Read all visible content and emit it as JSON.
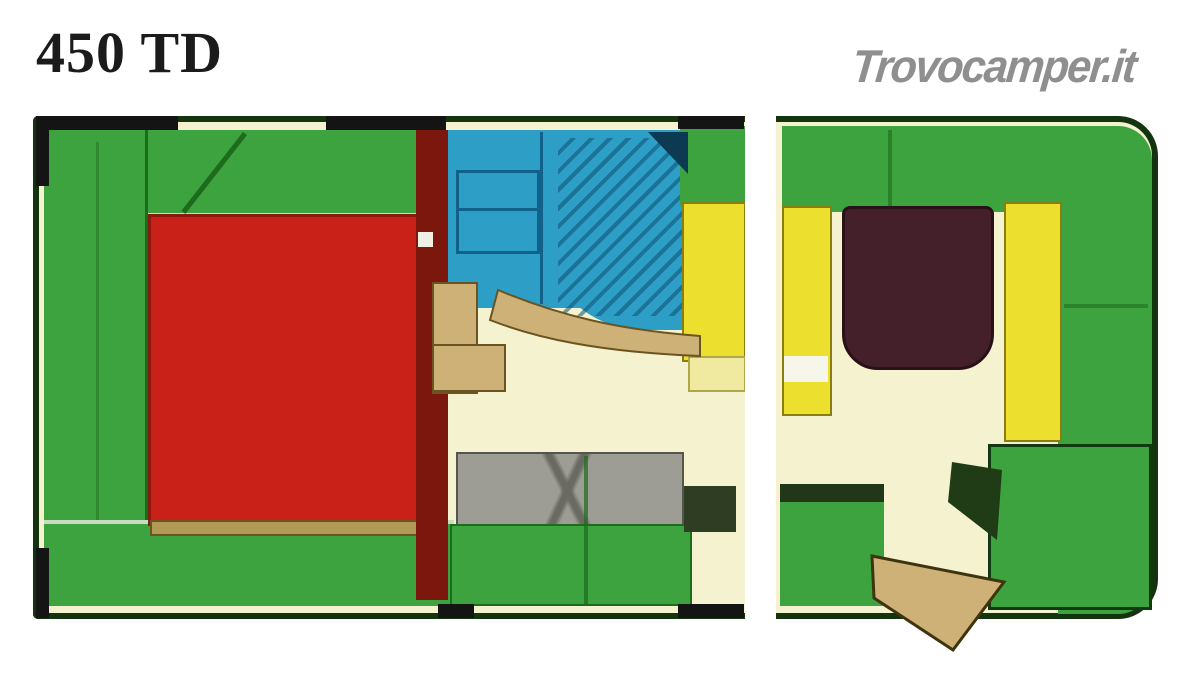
{
  "header": {
    "model_title": "450 TD"
  },
  "watermark": {
    "brand": "Trovocamper.it"
  },
  "palette": {
    "page_white": "#ffffff",
    "outline": "#14330f",
    "wall_green": "#3da33e",
    "green_dark_seam": "#1d6b1d",
    "dark_backrest_green": "#223618",
    "floor_cream": "#f5f3cf",
    "table_red": "#c92118",
    "table_red_edge": "#8a1a10",
    "table_trim_tan": "#b19a56",
    "divider_maroon": "#7b170d",
    "bathroom_blue": "#2d9ec6",
    "bathroom_blue_dark": "#11618a",
    "bathroom_corner_dark": "#0b3a52",
    "kitchen_yellow": "#ecdf2e",
    "pale_yellow": "#f0eaa0",
    "wood_tan": "#cdb176",
    "wood_tan_dark": "#6b5322",
    "sofa_gray": "#9d9d96",
    "sofa_gray_dark": "#55554e",
    "rear_table_brown": "#44202a",
    "dark_olive": "#2f3d22",
    "logo_gray": "#8f8f8f",
    "black": "#141414"
  },
  "floorplan": {
    "description_elements": [
      {
        "name": "front-dinette-benches",
        "color_key": "wall_green"
      },
      {
        "name": "front-table",
        "color_key": "table_red"
      },
      {
        "name": "partition-wall",
        "color_key": "divider_maroon"
      },
      {
        "name": "bathroom",
        "color_key": "bathroom_blue"
      },
      {
        "name": "kitchen-unit",
        "color_key": "kitchen_yellow"
      },
      {
        "name": "middle-sofa",
        "color_key": "sofa_gray"
      },
      {
        "name": "rear-dinette-benches",
        "color_key": "wall_green"
      },
      {
        "name": "rear-seat-cushions",
        "color_key": "kitchen_yellow"
      },
      {
        "name": "rear-table",
        "color_key": "rear_table_brown"
      },
      {
        "name": "wardrobe",
        "color_key": "wall_green"
      },
      {
        "name": "entrance-door",
        "color_key": "wood_tan"
      }
    ]
  }
}
